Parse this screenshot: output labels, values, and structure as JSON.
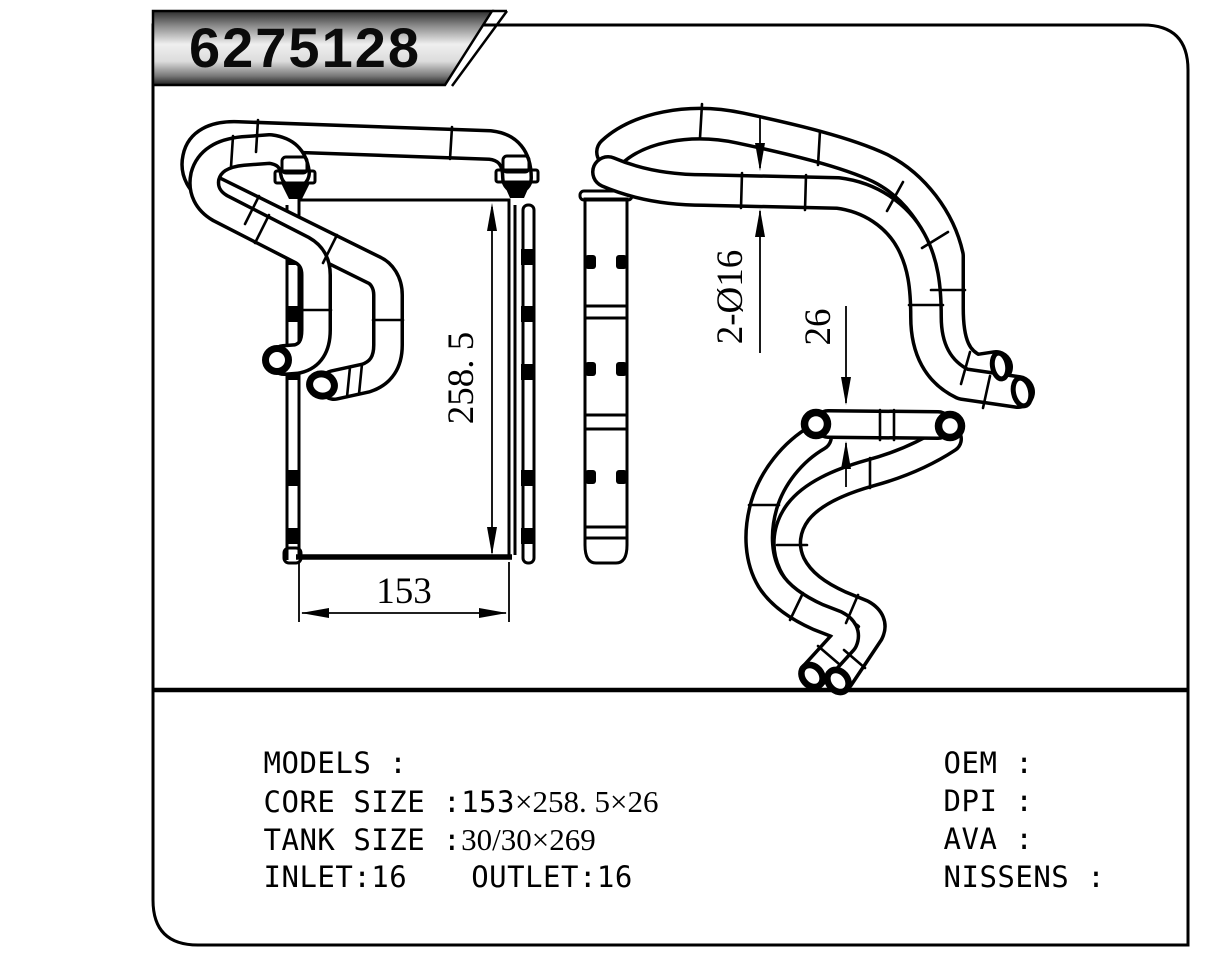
{
  "badge": {
    "part_number": "6275128"
  },
  "drawing": {
    "dim_height": "258. 5",
    "dim_width": "153",
    "dim_ports": "2-Ø16",
    "dim_depth": "26"
  },
  "specs": {
    "models_label": "MODELS :",
    "core_label": "CORE SIZE :",
    "core_value_mono": "153",
    "core_value_serif": "×258. 5×26",
    "tank_label": "TANK SIZE :",
    "tank_value": "30/30×269",
    "inlet": "INLET:16",
    "outlet": "OUTLET:16",
    "oem_label": "OEM :",
    "dpi_label": "DPI :",
    "ava_label": "AVA :",
    "nissens_label": "NISSENS :"
  },
  "colors": {
    "line": "#000000",
    "paper": "#ffffff"
  }
}
